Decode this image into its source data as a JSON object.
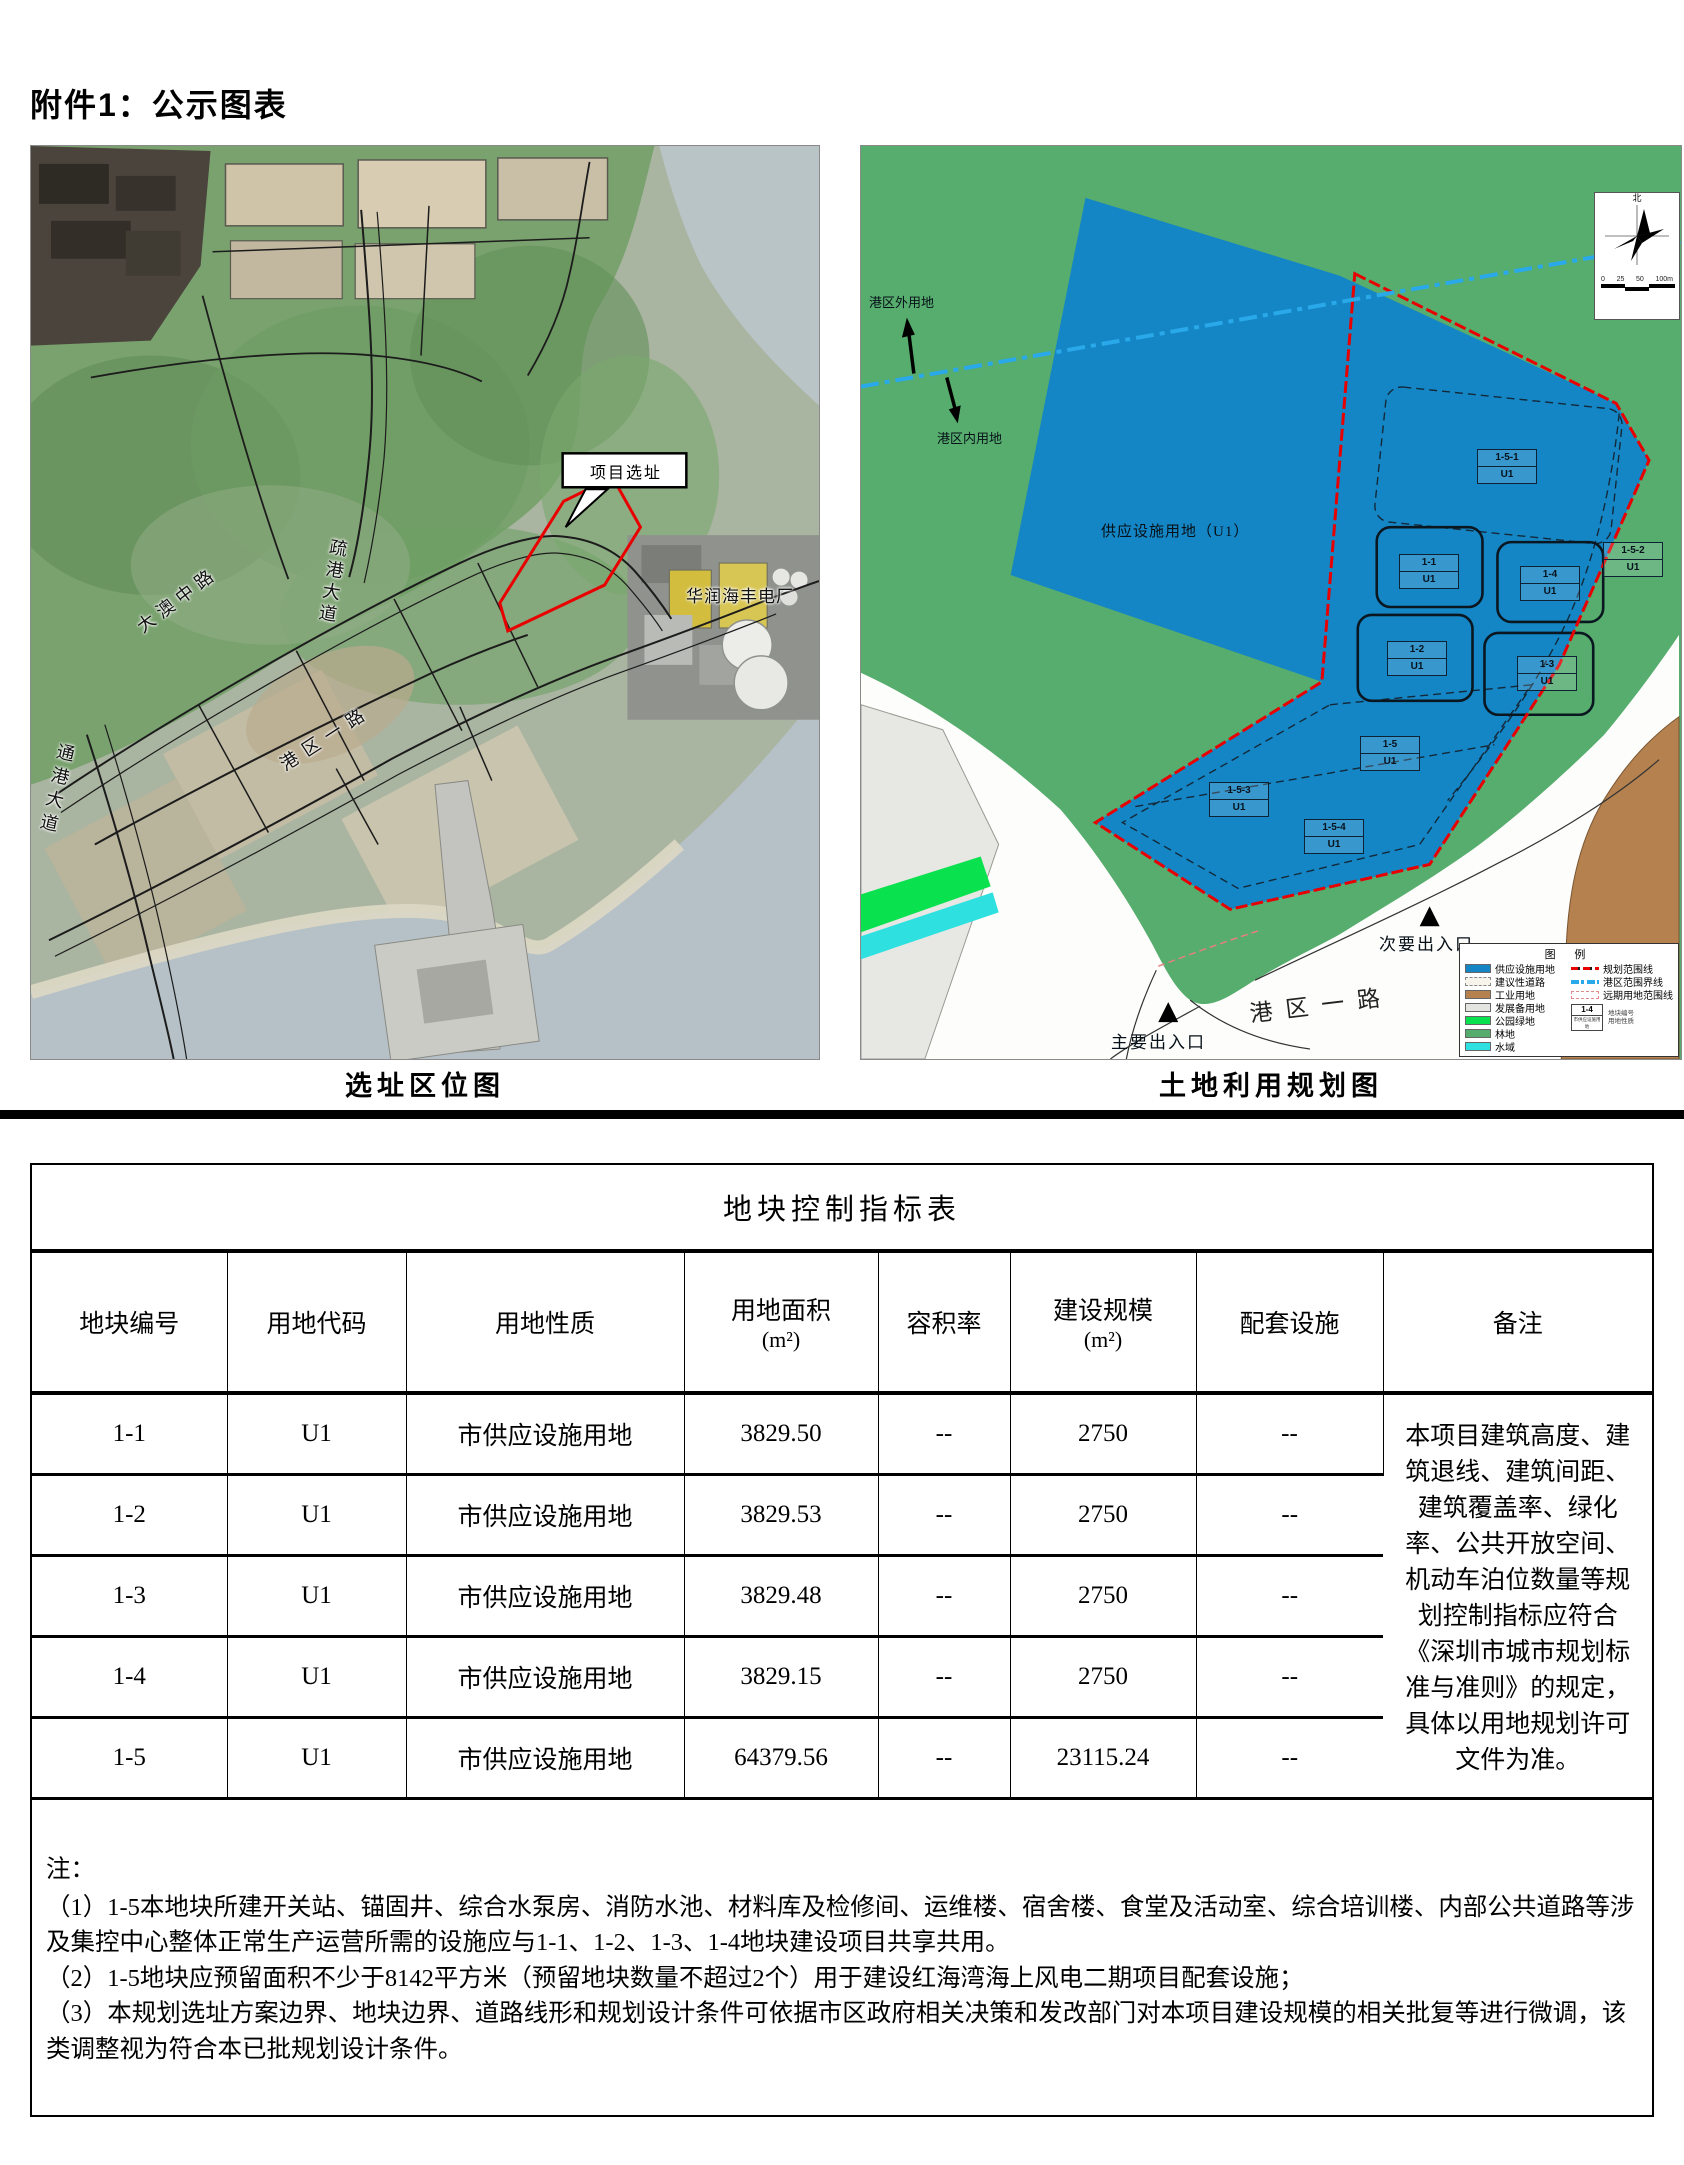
{
  "page": {
    "title": "附件1：公示图表"
  },
  "left_map": {
    "caption": "选址区位图",
    "callout_label": "项目选址",
    "road_labels": {
      "daao_middle_road": "大澳中路",
      "shugang_avenue": "疏港大道",
      "tonggang_avenue": "通港大道",
      "gangqu_road_1": "港区一路"
    },
    "plant_label": "华润海丰电厂"
  },
  "right_map": {
    "caption": "土地利用规划图",
    "supply_area_label": "供应设施用地（U1）",
    "outside_port_label": "港区外用地",
    "inside_port_label": "港区内用地",
    "road_label": "港区一路",
    "main_entrance_label": "主要出入口",
    "secondary_entrance_label": "次要出入口",
    "north_label": "北",
    "scale_labels": {
      "t0": "0",
      "t1": "25",
      "t2": "50",
      "t3": "100m"
    },
    "plots": [
      {
        "id": "1-5-1",
        "code": "U1"
      },
      {
        "id": "1-1",
        "code": "U1"
      },
      {
        "id": "1-4",
        "code": "U1"
      },
      {
        "id": "1-5-2",
        "code": "U1"
      },
      {
        "id": "1-2",
        "code": "U1"
      },
      {
        "id": "1-3",
        "code": "U1"
      },
      {
        "id": "1-5",
        "code": "U1"
      },
      {
        "id": "1-5-3",
        "code": "U1"
      },
      {
        "id": "1-5-4",
        "code": "U1"
      }
    ],
    "legend": {
      "title": "图 例",
      "area_items": [
        {
          "label": "供应设施用地",
          "color": "#1586c5"
        },
        {
          "label": "建议性道路",
          "color": "#f7f4ec"
        },
        {
          "label": "工业用地",
          "color": "#b5814f"
        },
        {
          "label": "发展备用地",
          "color": "#e4e4e1"
        },
        {
          "label": "公园绿地",
          "color": "#0ae14e"
        },
        {
          "label": "林地",
          "color": "#55ac6c"
        },
        {
          "label": "水域",
          "color": "#2ee0e0"
        }
      ],
      "line_items": [
        {
          "label": "规划范围线",
          "color": "#e60000"
        },
        {
          "label": "港区范围界线",
          "color": "#29a9ea"
        },
        {
          "label": "远期用地范围线",
          "color": "#e08a8a"
        }
      ],
      "sample": {
        "id": "1-4",
        "sub": "市供应设施用地",
        "note_top": "地块编号",
        "note_bottom": "用地性质"
      }
    }
  },
  "table": {
    "title": "地块控制指标表",
    "headers": [
      {
        "line1": "地块编号"
      },
      {
        "line1": "用地代码"
      },
      {
        "line1": "用地性质"
      },
      {
        "line1": "用地面积",
        "line2": "(m²)"
      },
      {
        "line1": "容积率"
      },
      {
        "line1": "建设规模",
        "line2": "(m²)"
      },
      {
        "line1": "配套设施"
      },
      {
        "line1": "备注"
      }
    ],
    "rows": [
      {
        "id": "1-1",
        "code": "U1",
        "nature": "市供应设施用地",
        "area": "3829.50",
        "far": "--",
        "scale": "2750",
        "facility": "--"
      },
      {
        "id": "1-2",
        "code": "U1",
        "nature": "市供应设施用地",
        "area": "3829.53",
        "far": "--",
        "scale": "2750",
        "facility": "--"
      },
      {
        "id": "1-3",
        "code": "U1",
        "nature": "市供应设施用地",
        "area": "3829.48",
        "far": "--",
        "scale": "2750",
        "facility": "--"
      },
      {
        "id": "1-4",
        "code": "U1",
        "nature": "市供应设施用地",
        "area": "3829.15",
        "far": "--",
        "scale": "2750",
        "facility": "--"
      },
      {
        "id": "1-5",
        "code": "U1",
        "nature": "市供应设施用地",
        "area": "64379.56",
        "far": "--",
        "scale": "23115.24",
        "facility": "--"
      }
    ],
    "remark": "本项目建筑高度、建筑退线、建筑间距、建筑覆盖率、绿化率、公共开放空间、机动车泊位数量等规划控制指标应符合《深圳市城市规划标准与准则》的规定，具体以用地规划许可文件为准。"
  },
  "notes": {
    "label": "注：",
    "items": [
      "（1）1-5本地块所建开关站、锚固井、综合水泵房、消防水池、材料库及检修间、运维楼、宿舍楼、食堂及活动室、综合培训楼、内部公共道路等涉及集控中心整体正常生产运营所需的设施应与1-1、1-2、1-3、1-4地块建设项目共享共用。",
      "（2）1-5地块应预留面积不少于8142平方米（预留地块数量不超过2个）用于建设红海湾海上风电二期项目配套设施；",
      "（3）本规划选址方案边界、地块边界、道路线形和规划设计条件可依据市区政府相关决策和发改部门对本项目建设规模的相关批复等进行微调，该类调整视为符合本已批规划设计条件。"
    ]
  }
}
